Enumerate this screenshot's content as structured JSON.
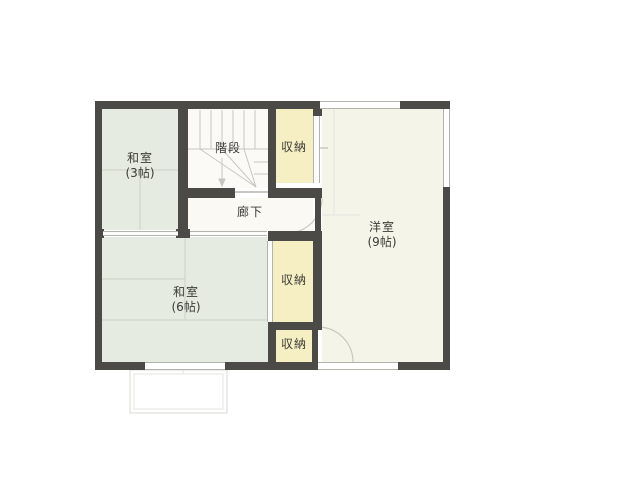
{
  "rooms": {
    "washitsu3": {
      "name": "和室",
      "size": "(3帖)"
    },
    "stairs": {
      "name": "階段"
    },
    "closet_top": {
      "name": "収納"
    },
    "hallway": {
      "name": "廊下"
    },
    "youshitsu": {
      "name": "洋室",
      "size": "(9帖)"
    },
    "washitsu6": {
      "name": "和室",
      "size": "(6帖)"
    },
    "closet_middle": {
      "name": "収納"
    },
    "closet_bottom": {
      "name": "収納"
    }
  },
  "colors": {
    "wall": "#4b4a46",
    "tatami": "#e5ebe0",
    "western": "#f5f4e9",
    "closet": "#f6efc3",
    "stairsFloor": "#fbfaf7",
    "corridor": "#faf9f4",
    "line": "#c7c7c1",
    "lineLight": "#e4e4de",
    "frame": "#b3b3ae",
    "seam": "#ccd3c5",
    "veranda": "#d9d9d3",
    "text": "#3b3b37"
  }
}
